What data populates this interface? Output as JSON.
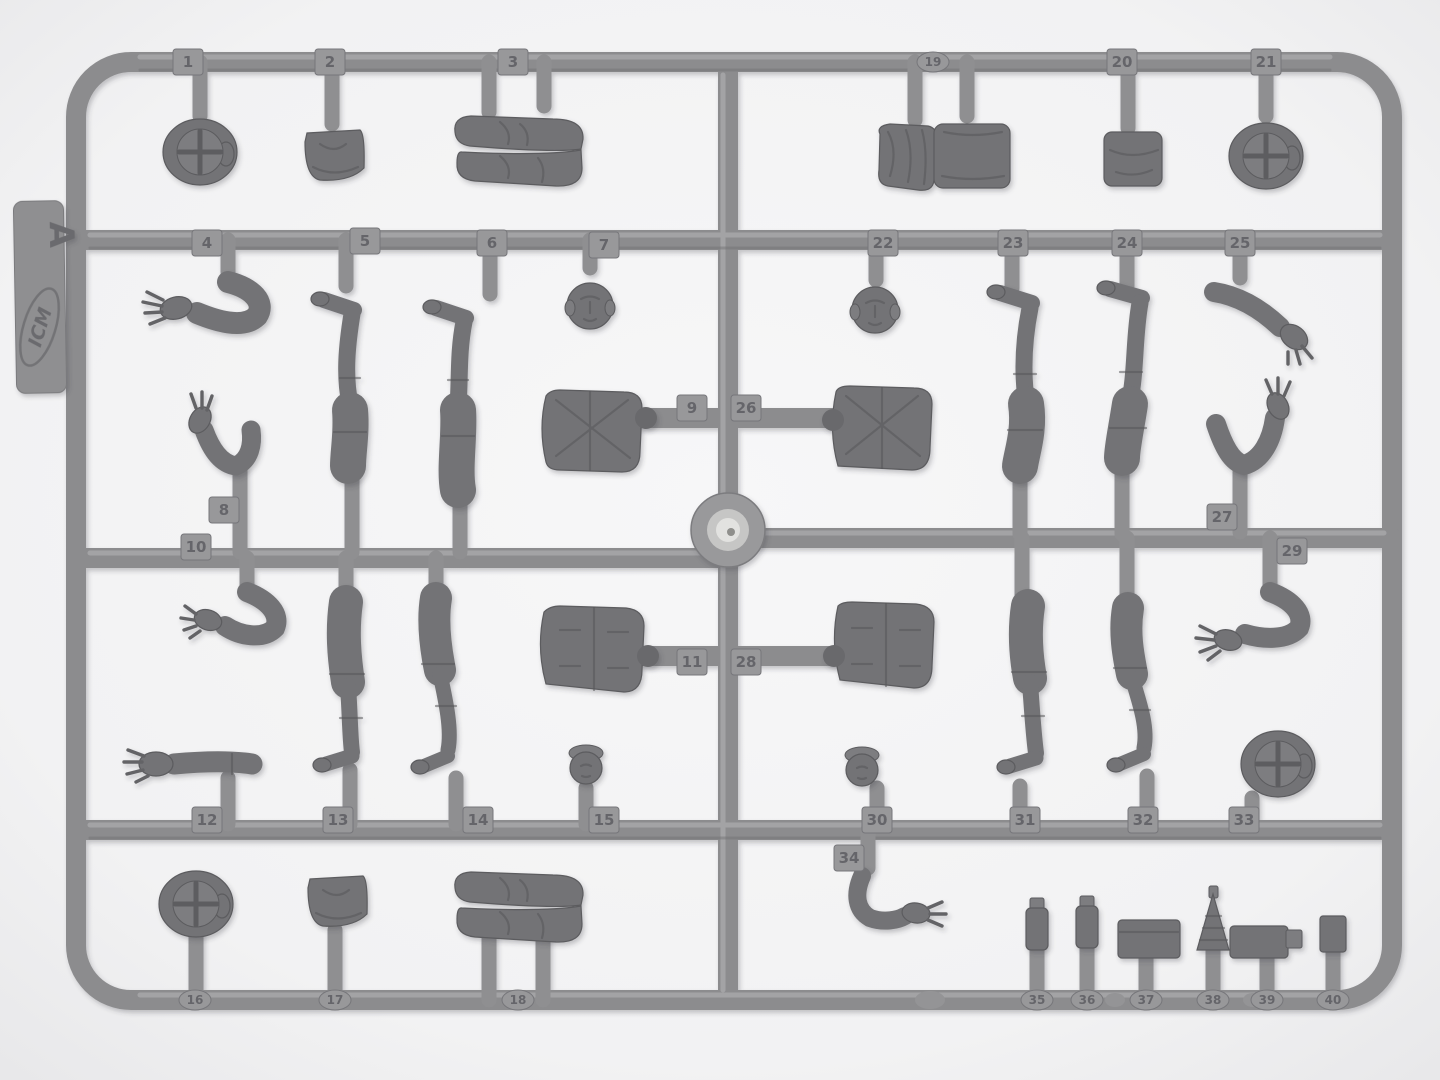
{
  "scene": {
    "description": "Photograph of a grey injection-molded plastic model sprue (runner frame) with numbered WWII figure parts on a white background",
    "sprue_letter": "A",
    "brand_logo": "ICM",
    "center_feature": "round ejector boss at sprue center"
  },
  "colors": {
    "background": "#f3f3f4",
    "plastic_runner": "#8c8c8e",
    "plastic_parts": "#737376",
    "tab_number": "#606065"
  },
  "sprue_label": {
    "letter": "A",
    "logo": "ICM"
  },
  "part_tags": [
    {
      "n": "1",
      "x": 188,
      "y": 62
    },
    {
      "n": "2",
      "x": 330,
      "y": 62
    },
    {
      "n": "3",
      "x": 513,
      "y": 62
    },
    {
      "n": "19",
      "x": 933,
      "y": 62,
      "oval": true
    },
    {
      "n": "20",
      "x": 1122,
      "y": 62
    },
    {
      "n": "21",
      "x": 1266,
      "y": 62
    },
    {
      "n": "4",
      "x": 207,
      "y": 243
    },
    {
      "n": "5",
      "x": 365,
      "y": 241
    },
    {
      "n": "6",
      "x": 492,
      "y": 243
    },
    {
      "n": "7",
      "x": 604,
      "y": 245
    },
    {
      "n": "22",
      "x": 883,
      "y": 243
    },
    {
      "n": "23",
      "x": 1013,
      "y": 243
    },
    {
      "n": "24",
      "x": 1127,
      "y": 243
    },
    {
      "n": "25",
      "x": 1240,
      "y": 243
    },
    {
      "n": "8",
      "x": 224,
      "y": 510
    },
    {
      "n": "9",
      "x": 692,
      "y": 408
    },
    {
      "n": "26",
      "x": 746,
      "y": 408
    },
    {
      "n": "10",
      "x": 196,
      "y": 547
    },
    {
      "n": "27",
      "x": 1222,
      "y": 517
    },
    {
      "n": "11",
      "x": 692,
      "y": 662
    },
    {
      "n": "28",
      "x": 746,
      "y": 662
    },
    {
      "n": "29",
      "x": 1292,
      "y": 551
    },
    {
      "n": "12",
      "x": 207,
      "y": 820
    },
    {
      "n": "13",
      "x": 338,
      "y": 820
    },
    {
      "n": "14",
      "x": 478,
      "y": 820
    },
    {
      "n": "15",
      "x": 604,
      "y": 820
    },
    {
      "n": "30",
      "x": 877,
      "y": 820
    },
    {
      "n": "31",
      "x": 1025,
      "y": 820
    },
    {
      "n": "32",
      "x": 1143,
      "y": 820
    },
    {
      "n": "33",
      "x": 1244,
      "y": 820
    },
    {
      "n": "34",
      "x": 849,
      "y": 858
    },
    {
      "n": "16",
      "x": 195,
      "y": 1000,
      "oval": true
    },
    {
      "n": "17",
      "x": 335,
      "y": 1000,
      "oval": true
    },
    {
      "n": "18",
      "x": 518,
      "y": 1000,
      "oval": true
    },
    {
      "n": "35",
      "x": 1037,
      "y": 1000,
      "oval": true
    },
    {
      "n": "36",
      "x": 1087,
      "y": 1000,
      "oval": true
    },
    {
      "n": "37",
      "x": 1146,
      "y": 1000,
      "oval": true
    },
    {
      "n": "38",
      "x": 1213,
      "y": 1000,
      "oval": true
    },
    {
      "n": "39",
      "x": 1267,
      "y": 1000,
      "oval": true
    },
    {
      "n": "40",
      "x": 1333,
      "y": 1000,
      "oval": true
    }
  ],
  "parts_inventory": [
    {
      "n": 1,
      "type": "peaked cap (top view)"
    },
    {
      "n": 2,
      "type": "side cap"
    },
    {
      "n": 3,
      "type": "pair of boots"
    },
    {
      "n": 4,
      "type": "arm"
    },
    {
      "n": 5,
      "type": "leg"
    },
    {
      "n": 6,
      "type": "leg"
    },
    {
      "n": 7,
      "type": "head"
    },
    {
      "n": 8,
      "type": "bent arm"
    },
    {
      "n": 9,
      "type": "torso"
    },
    {
      "n": 10,
      "type": "bent arm"
    },
    {
      "n": 11,
      "type": "torso"
    },
    {
      "n": 12,
      "type": "extended arm"
    },
    {
      "n": 13,
      "type": "leg"
    },
    {
      "n": 14,
      "type": "leg"
    },
    {
      "n": 15,
      "type": "head"
    },
    {
      "n": 16,
      "type": "peaked cap (top view)"
    },
    {
      "n": 17,
      "type": "side cap"
    },
    {
      "n": 18,
      "type": "pair of boots"
    },
    {
      "n": 19,
      "type": "backpack with rolled blanket"
    },
    {
      "n": 20,
      "type": "pouch"
    },
    {
      "n": 21,
      "type": "peaked cap (top view)"
    },
    {
      "n": 22,
      "type": "head"
    },
    {
      "n": 23,
      "type": "leg"
    },
    {
      "n": 24,
      "type": "leg"
    },
    {
      "n": 25,
      "type": "arm"
    },
    {
      "n": 26,
      "type": "torso"
    },
    {
      "n": 27,
      "type": "raised bent arm"
    },
    {
      "n": 28,
      "type": "torso"
    },
    {
      "n": 29,
      "type": "bent arm"
    },
    {
      "n": 30,
      "type": "head"
    },
    {
      "n": 31,
      "type": "leg"
    },
    {
      "n": 32,
      "type": "leg"
    },
    {
      "n": 33,
      "type": "peaked cap (top view)"
    },
    {
      "n": 34,
      "type": "arm"
    },
    {
      "n": 35,
      "type": "small equipment"
    },
    {
      "n": 36,
      "type": "small equipment"
    },
    {
      "n": 37,
      "type": "equipment box"
    },
    {
      "n": 38,
      "type": "conical grenade"
    },
    {
      "n": 39,
      "type": "mess tin"
    },
    {
      "n": 40,
      "type": "small equipment"
    }
  ]
}
